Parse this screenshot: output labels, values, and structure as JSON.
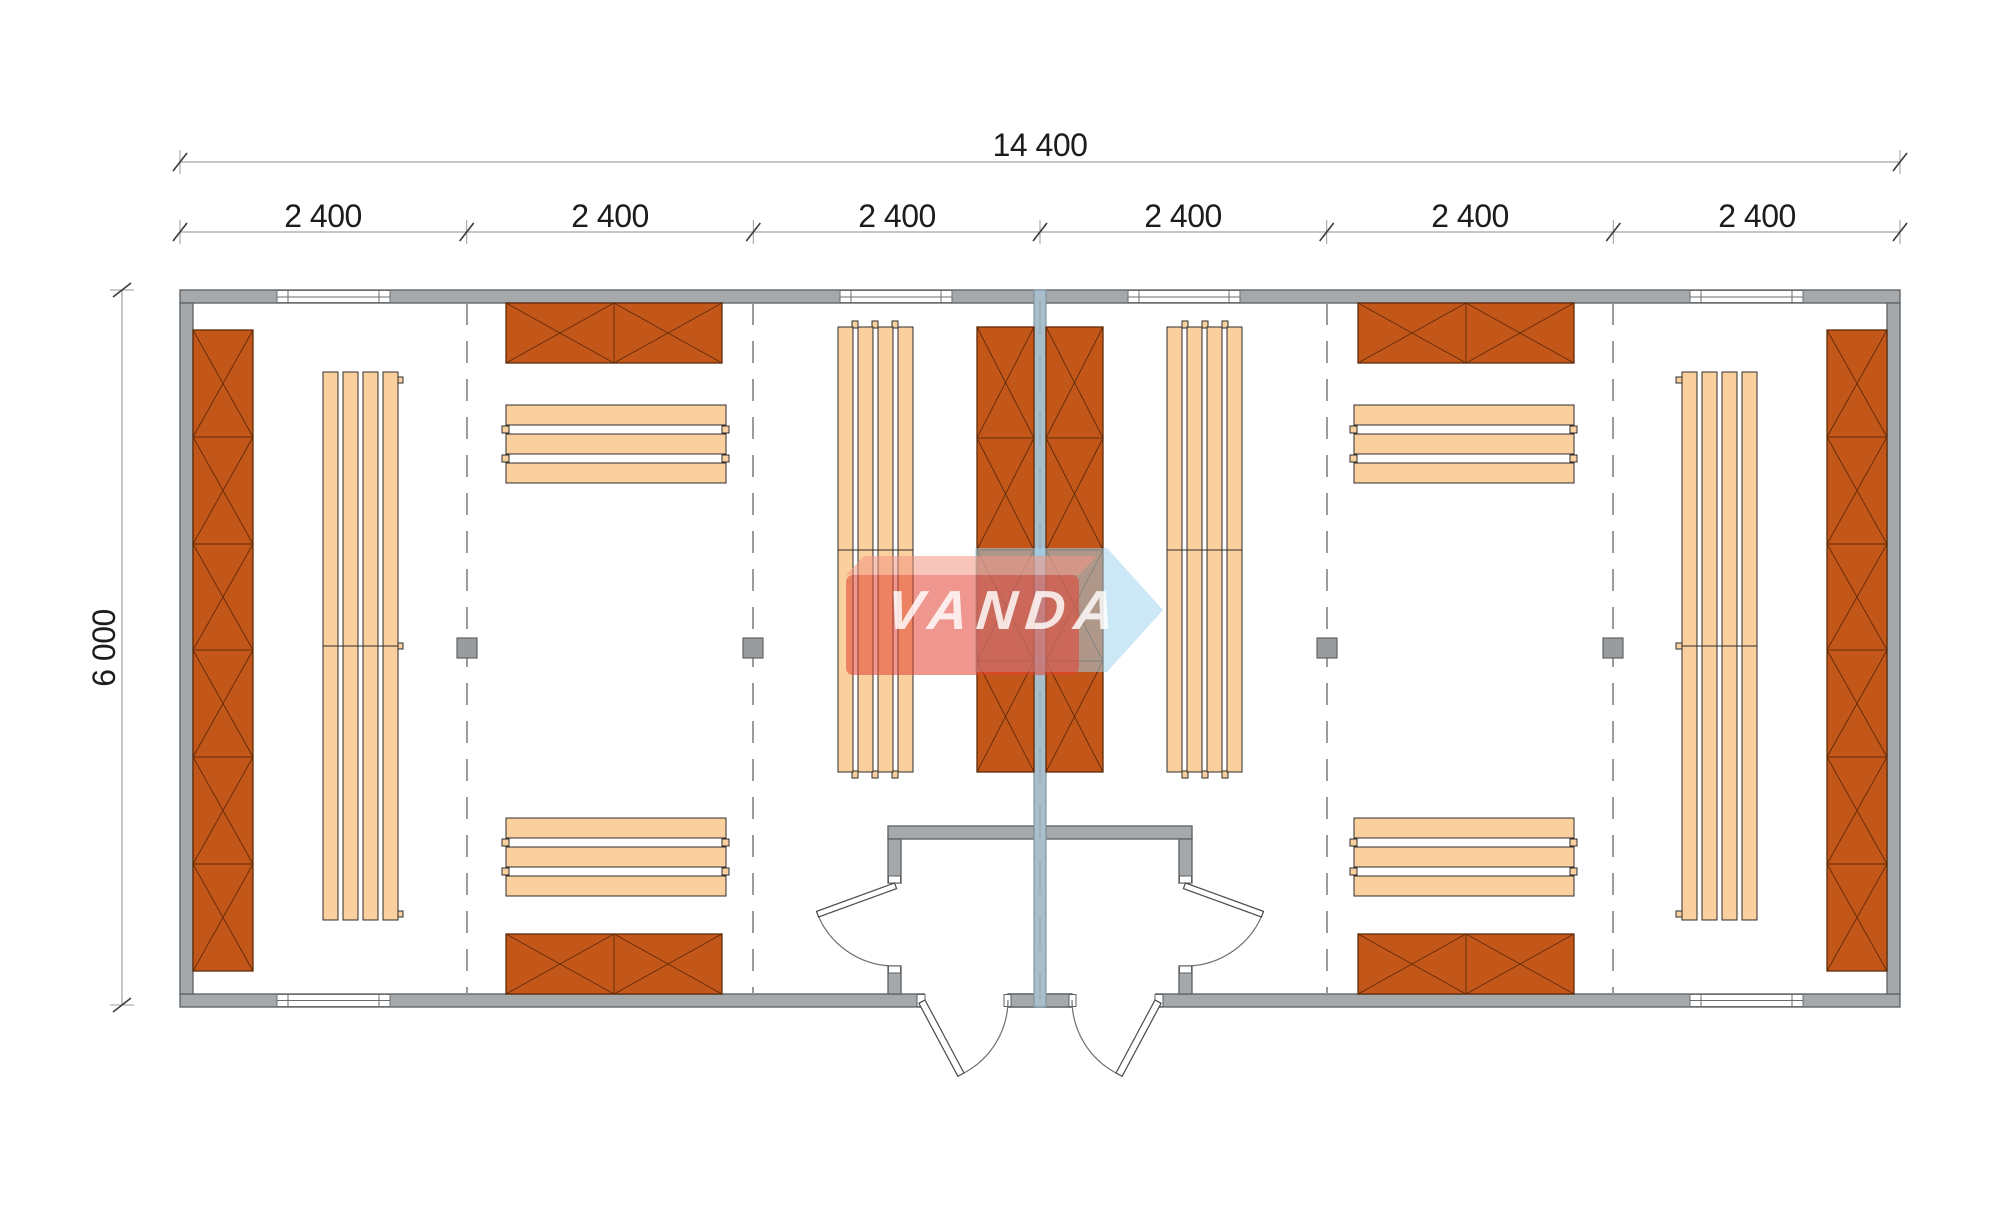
{
  "page": {
    "type": "architectural-floor-plan",
    "background": "#ffffff",
    "description": "Plan of a modular building 14 400 x 6 000 with two mirrored locker rooms, central partition and entrance vestibule"
  },
  "dimensions": {
    "total_width_label": "14 400",
    "height_label": "6 000",
    "module_labels": [
      "2 400",
      "2 400",
      "2 400",
      "2 400",
      "2 400",
      "2 400"
    ]
  },
  "watermark": {
    "text": "VANDA",
    "red": "#e24231",
    "light_red": "#f29684",
    "blue": "#9ed3f0"
  },
  "plan": {
    "wall_color": "#a6a9ab",
    "partition_color": "#a9becb",
    "locker_color": "#c3571a",
    "bench_color": "#f9d09e",
    "dash_color": "#9b9b9b",
    "inventory": {
      "modules": 6,
      "lockers": 10,
      "benches": 8,
      "columns": 4,
      "windows": 6,
      "interior_doors": 2,
      "exterior_doors": 2
    }
  }
}
